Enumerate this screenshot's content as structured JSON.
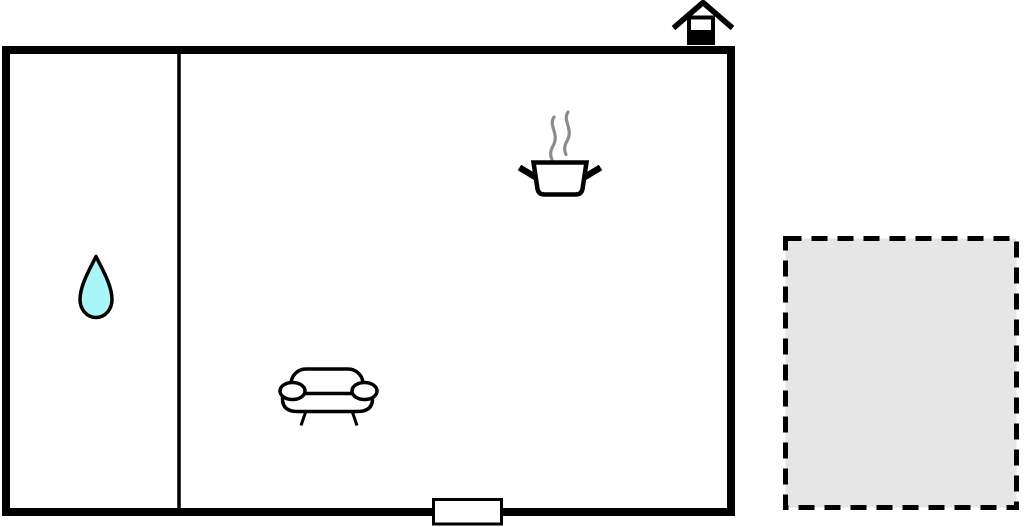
{
  "page": {
    "type": "floor-plan-diagram",
    "background_color": "#ffffff"
  },
  "colors": {
    "page_bg": "#ffffff",
    "wall": "#000000",
    "room_fill": "#ffffff",
    "drop_fill": "#aaf6f6",
    "terrace_fill": "#e6e6e6",
    "steam": "#8c8c8c"
  },
  "plan": {
    "building": "building-outline-with-thick-black-walls",
    "interior_wall": "vertical-divider-between-left-room-and-main-room",
    "door": "door-opening-in-bottom-wall",
    "terrace": "dashed-border-gray-terrace-square",
    "icons": [
      {
        "name": "house-icon",
        "glyph": "house-marker-on-top-wall"
      },
      {
        "name": "water-drop-icon",
        "glyph": "cyan-teardrop"
      },
      {
        "name": "cooking-pot-icon",
        "glyph": "pot-with-two-handles"
      },
      {
        "name": "steam-icon",
        "glyph": "two-wavy-lines"
      },
      {
        "name": "sofa-icon",
        "glyph": "sofa-with-round-armrests"
      }
    ]
  }
}
